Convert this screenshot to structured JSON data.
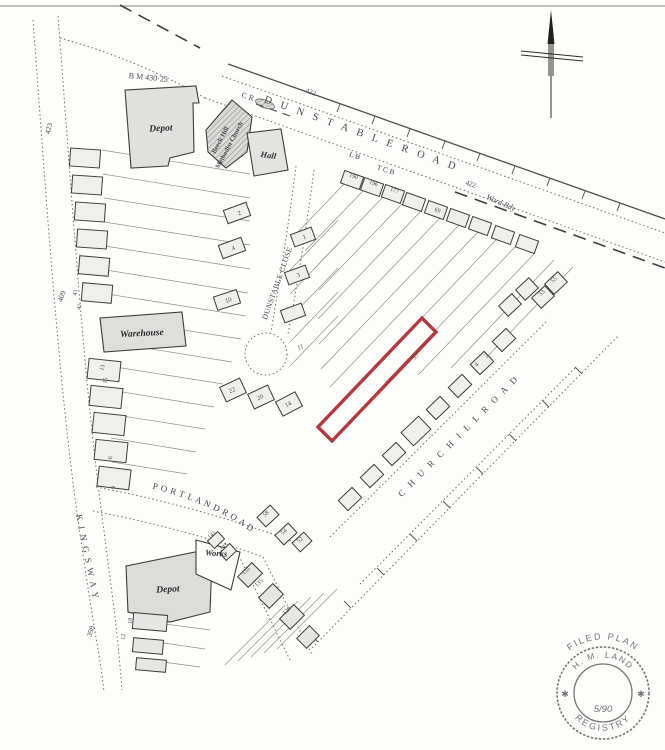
{
  "plan": {
    "roads": {
      "dunstable_road": "D U N S T A B L E   R O A D",
      "dunstable_close": "DUNSTABLE  CLOSE",
      "churchill_road": "C H U R C H I L L   R O A D",
      "portland_road": "P O R T L A N D   R O A D",
      "kingsway": "K I N G S W A Y"
    },
    "buildings": {
      "depot_north": "Depot",
      "depot_south": "Depot",
      "warehouse": "Warehouse",
      "hall": "Hall",
      "church_line1": "Beech Hill",
      "church_line2": "Methodist Church",
      "works": "Works"
    },
    "annotations": {
      "bench_mark": "B M 430·25",
      "cr": "C R",
      "ward_boundary": "Ward Bdy",
      "letter_box": "L B",
      "telephone_call_box": "T C B",
      "level_422_west": "422",
      "level_422_east": "422",
      "parcel_423": "423",
      "parcel_409": "409",
      "parcel_398": "398"
    },
    "house_numbers": {
      "dunstable_close_west": [
        "2",
        "4",
        "10",
        "22",
        "20",
        "14"
      ],
      "dunstable_close_east": [
        "1",
        "3",
        "11"
      ],
      "dunstable_road_houses": [
        "190",
        "196",
        "177",
        "69",
        "53",
        "55"
      ],
      "churchill_road_houses": [
        "57",
        "4",
        "2",
        "58",
        "54"
      ],
      "portland_road_houses": [
        "141",
        "143",
        "52",
        "133",
        "135",
        "129"
      ],
      "left_terrace": [
        "43",
        "41",
        "13",
        "15",
        "6",
        "9"
      ],
      "kingsway_south": [
        "18",
        "12"
      ]
    },
    "plot": {
      "outline_color": "#b5383c"
    },
    "stamp": {
      "arc_top": "FILED PLAN",
      "arc_middle": "H. M. LAND",
      "arc_bottom": "REGISTRY",
      "date": "5/90",
      "star_left": "✱",
      "star_right": "✱"
    }
  }
}
